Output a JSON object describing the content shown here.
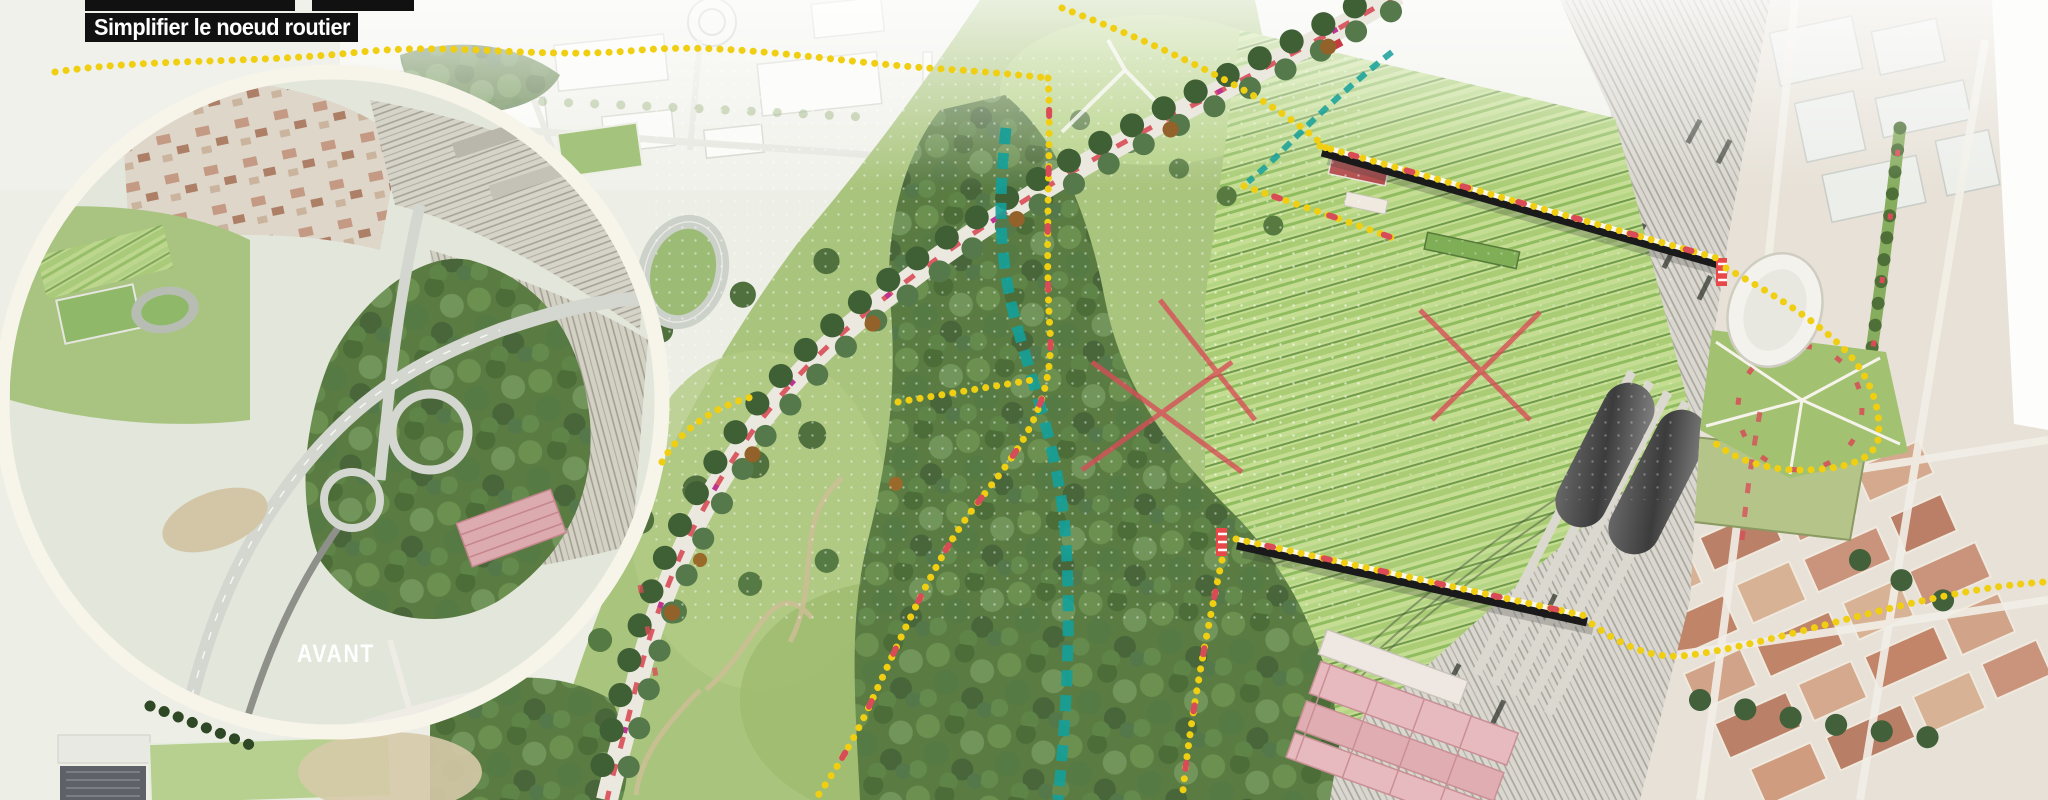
{
  "banner": {
    "label": "Simplifier le noeud routier",
    "bg": "#111111",
    "fg": "#ffffff"
  },
  "inset": {
    "label": "AVANT",
    "label_color": "#ffffff"
  },
  "colors": {
    "route_yellow": "#f0cf12",
    "route_red": "#d94b57",
    "route_magenta": "#bf3390",
    "stream_teal": "#14a09a",
    "bridge_black": "#1a1a1a",
    "bridge_white": "#fbf8ee",
    "ring_white": "#f7f4ea",
    "lawn_green": "#a9c47c",
    "canopy_green": "#5a7c42",
    "rail_gray": "#d9d7cf",
    "allotment_green": "#c4dd92",
    "warehouse_pink": "#e4b6ba",
    "roof_salmon": "#c9937c",
    "dome_white": "#f3f2ec"
  }
}
